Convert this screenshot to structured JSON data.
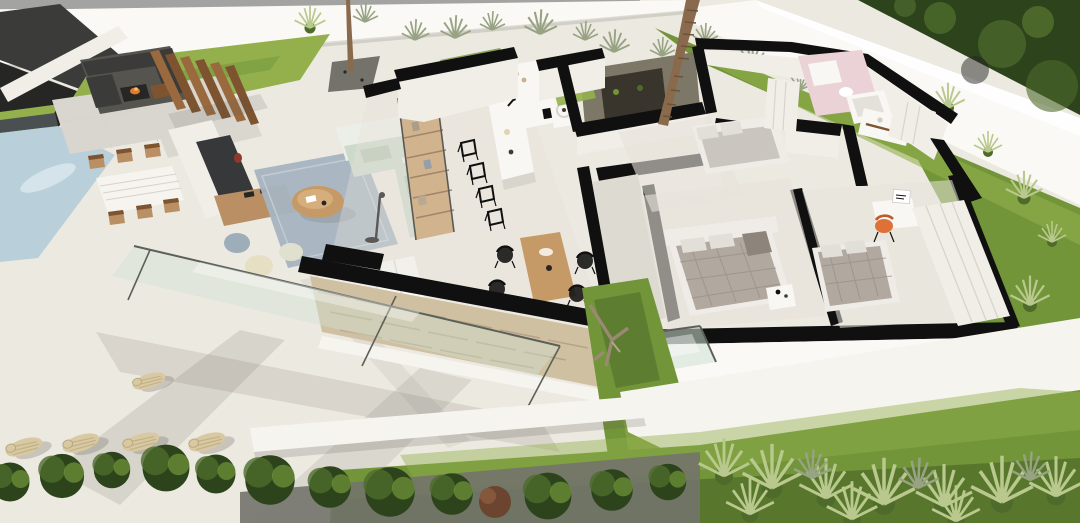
{
  "scene": {
    "type": "3D aerial cutaway floor-plan render of a modern single-storey villa with garden and pool",
    "visible_text": "none (architectural render contains no readable text; one tiny illegible product label on a desk box)",
    "view": "bird's-eye dollhouse view, walls cut horizontally showing black wall tops, strong sunlight casting long shadows toward lower-left",
    "outdoor_left": [
      "swimming pool (pale blue, upper left)",
      "sunken fire-pit lounge with charcoal sectional sofas and burning fire pit",
      "timber slat privacy screen (pergola)",
      "large stone pavers",
      "outdoor dining table (white slatted top) with six timber chairs",
      "outdoor TV media wall with wooden console and red vase",
      "round wooden coffee table",
      "carport / dark garage structure in extreme top-left corner",
      "white terrace with long diagonal shadows",
      "row of five wicker sun loungers (bottom left)"
    ],
    "rooms": [
      {
        "name": "living room",
        "furniture": [
          "L-shaped sage-green sofa",
          "blue-grey area rug",
          "three poufs (slate, cream, pale)",
          "black floor lamp",
          "tall timber ladder bookshelf",
          "white low cabinet",
          "glass walls with green tint"
        ]
      },
      {
        "name": "open kitchen",
        "furniture": [
          "long white island with faucet",
          "four black wireframe bar chairs",
          "galley counter with black cooktop"
        ]
      },
      {
        "name": "indoor dining",
        "furniture": [
          "light timber dining table",
          "four black chairs"
        ]
      },
      {
        "name": "laundry / utility",
        "furniture": [
          "white appliance (washer)"
        ]
      },
      {
        "name": "internal courtyard",
        "furniture": [
          "palm tree trunk in black-framed planter"
        ]
      },
      {
        "name": "hallway",
        "furniture": []
      },
      {
        "name": "top bedroom",
        "furniture": [
          "bed with white linen",
          "white wardrobe"
        ]
      },
      {
        "name": "pink bathroom",
        "furniture": [
          "vanity",
          "toilet",
          "bathtub"
        ]
      },
      {
        "name": "en-suite bathroom with walk-in closet",
        "furniture": [
          "white vanity with timber shelf",
          "fitted white wardrobes"
        ]
      },
      {
        "name": "center bedroom",
        "furniture": [
          "double bed with grey quilted duvet and white pillows",
          "white headboard wall",
          "white nightstand",
          "glazed corner window"
        ]
      },
      {
        "name": "right bedroom",
        "furniture": [
          "double bed with grey quilted duvet",
          "white desk",
          "orange chair",
          "small white box with illegible label",
          "long fitted white wardrobes"
        ]
      }
    ],
    "architecture": [
      "black cut wall tops",
      "white wall faces",
      "beige dry-stone feature wall with black cap",
      "white perimeter fence along top and right",
      "bright white exterior plinths"
    ],
    "garden": [
      "bright lawn strip inside top-left fence",
      "long lawn band along right fence with grass clumps",
      "central lawn strip with driftwood sculpture",
      "large lawn across bottom",
      "row of clipped shrubs over dark gravel (bottom left)",
      "one dead brown plant",
      "feathery ornamental grasses (bottom right)",
      "grey-green planting bed along rear fence",
      "dense dark trees beyond the top-right wall",
      "slim tree on gravel patch near rear fence"
    ]
  },
  "palette": {
    "terrace": "#ECE9E1",
    "terraceBright": "#F6F4EE",
    "topStrip": "#A3A3A1",
    "wallWhite": "#FAF9F5",
    "wallFace": "#F1EEE8",
    "black": "#101010",
    "charcoal": "#3B3B39",
    "charcoalDark": "#262624",
    "grassBright": "#93B04D",
    "grassMid": "#729539",
    "grassDark": "#3E5A22",
    "foliageDark": "#2C431C",
    "foliageLight": "#4E6B2C",
    "plantGray": "#97A383",
    "grassTuft": "#B9C98E",
    "pool": "#B9CFDA",
    "poolLight": "#D9E7ED",
    "poolDark": "#4A5052",
    "pavers": "#D9D6CF",
    "woodSlat": "#9A6A3E",
    "woodDark": "#7D5330",
    "wood": "#B98F63",
    "woodLight": "#C59A66",
    "stone": "#D0C0A2",
    "stoneLine": "#B5A586",
    "counterWhite": "#F8F7F3",
    "sofaSage": "#CDD9CB",
    "sofaBack": "#ECEFE8",
    "rug": "#A7B4C0",
    "poufSlate": "#9DADB9",
    "poufCream": "#E6DFC3",
    "poufPale": "#DFE0CE",
    "bedQuilt": "#B1A89F",
    "bedLight": "#CAC5BF",
    "bedWhite": "#EFECE7",
    "pillow": "#E2DED8",
    "pink": "#EBD2D6",
    "orange": "#DF7038",
    "glassTint": "#CFE2D4",
    "glassFrame": "#5C6058",
    "gravel": "#73736C",
    "loungerBeige": "#D9C9A2",
    "loungerLine": "#C2B288",
    "trunkBrown": "#8A6A4C",
    "trunkRing": "#6E5238",
    "planterDark": "#3A352C",
    "floorWarm": "#E7E3DA",
    "hallFloor": "#DDDAD2",
    "shadow": "#5A584F",
    "redVase": "#8D3A2C",
    "firePitOrange": "#E07A2E",
    "deadPlant": "#6B4530",
    "tvDark": "#37383A"
  },
  "dimensions": {
    "width": 1080,
    "height": 523
  }
}
